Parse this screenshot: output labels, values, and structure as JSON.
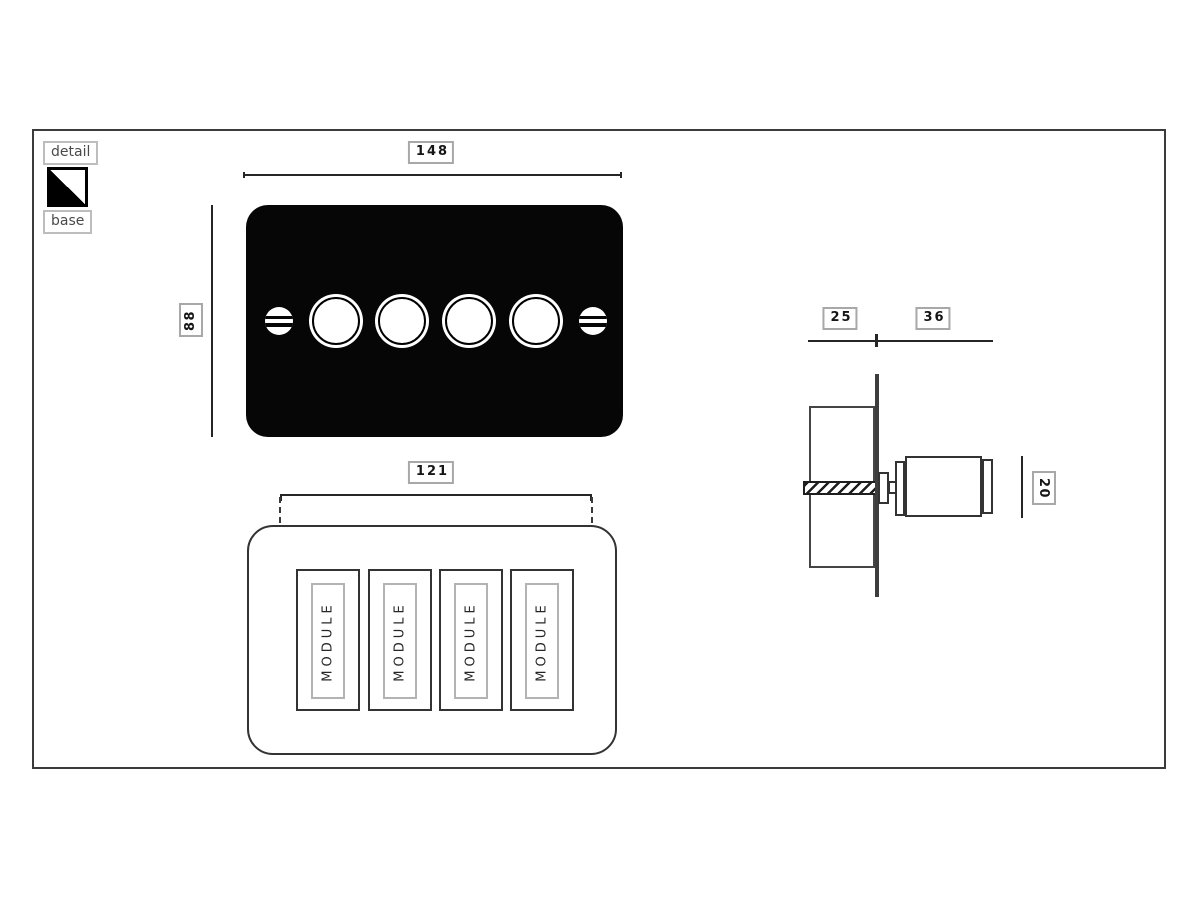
{
  "legend": {
    "detail_label": "detail",
    "base_label": "base",
    "detail_color": "#ffffff",
    "base_color": "#000000"
  },
  "front_view": {
    "width_dim": "148",
    "height_dim": "88",
    "plate_color": "#000000",
    "knob_count": 4,
    "screw_count": 2
  },
  "rear_view": {
    "width_dim": "121",
    "modules": [
      "MODULE",
      "MODULE",
      "MODULE",
      "MODULE"
    ]
  },
  "side_view": {
    "box_depth_dim": "25",
    "knob_depth_dim": "36",
    "knob_diameter_dim": "20"
  },
  "colors": {
    "background": "#ffffff",
    "line": "#333333",
    "frame_border": "#3b3b3b",
    "label_border": "#a8a8a8",
    "label_text": "#151515",
    "legend_text": "#4a4a4a"
  }
}
